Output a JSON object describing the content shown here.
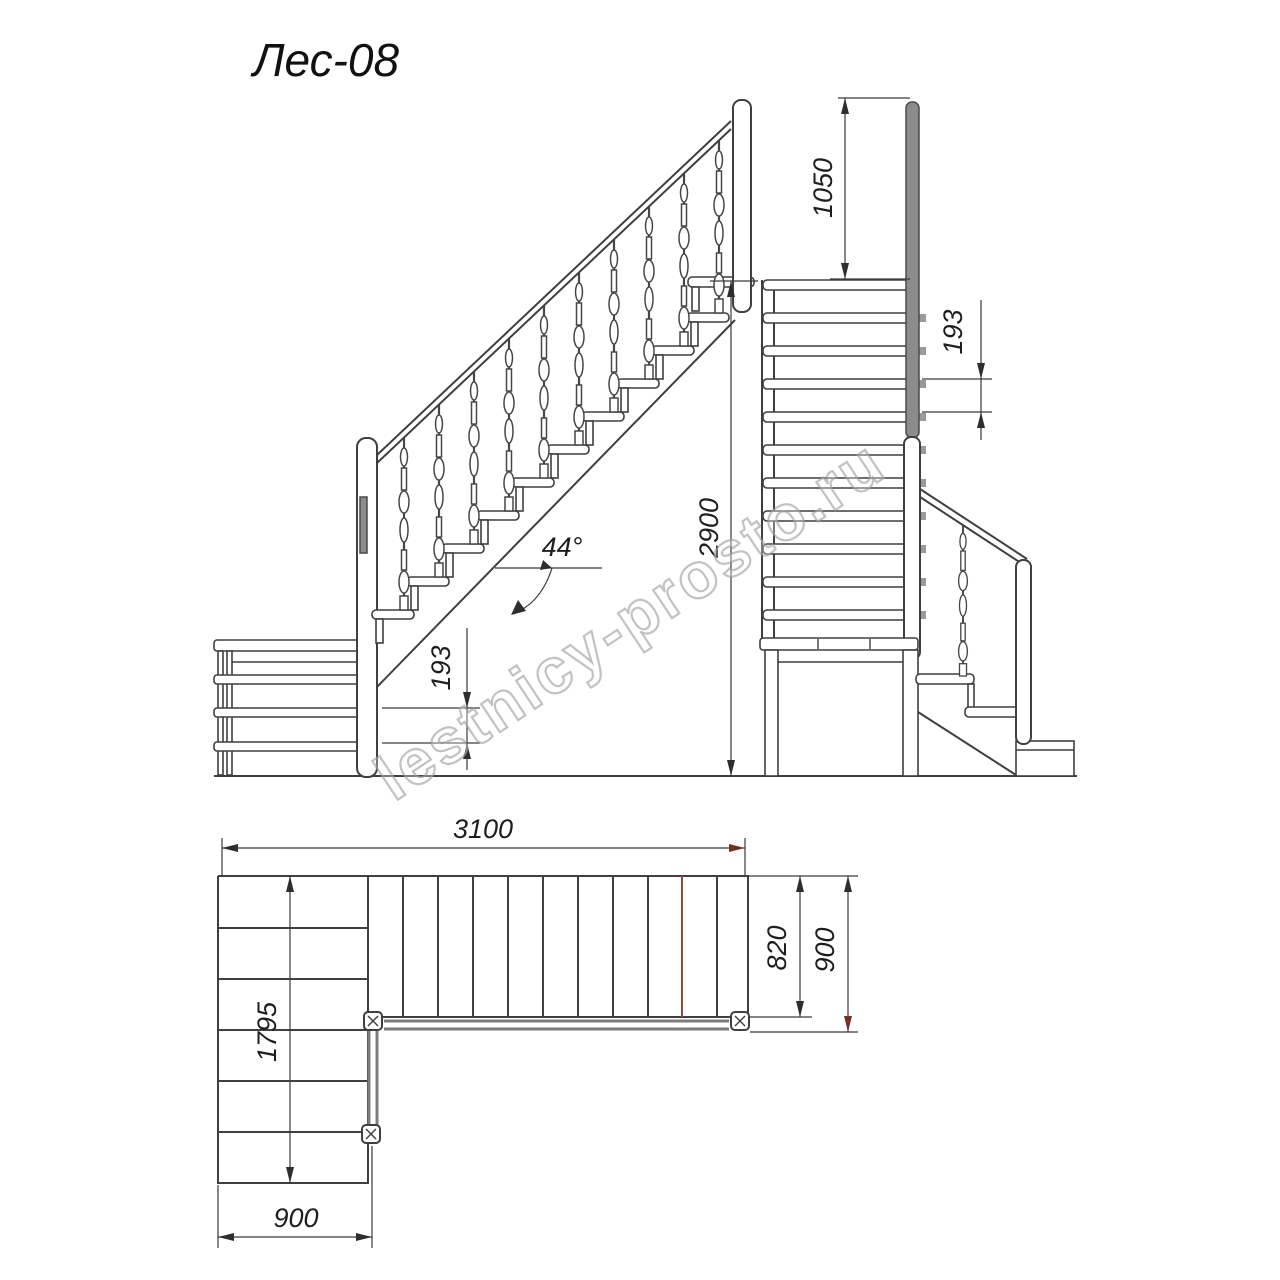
{
  "title": "Лес-08",
  "watermark": "lestnicy-prosto.ru",
  "side_view": {
    "dims": {
      "total_rise": "2900",
      "riser_height": "193",
      "stair_angle": "44°"
    }
  },
  "front_view": {
    "dims": {
      "railing_height": "1050",
      "riser_height": "193"
    }
  },
  "plan_view": {
    "dims": {
      "total_length": "3100",
      "lower_flight_length": "1795",
      "lower_flight_width": "900",
      "flight_width": "820",
      "flight_total_width": "900"
    }
  },
  "colors": {
    "line": "#3f3f3f",
    "post_fill": "#8c8c8c",
    "railing_gray": "#7c7c7c",
    "accent_red": "#7a2e20",
    "watermark_gray": "#9d9d9d"
  }
}
